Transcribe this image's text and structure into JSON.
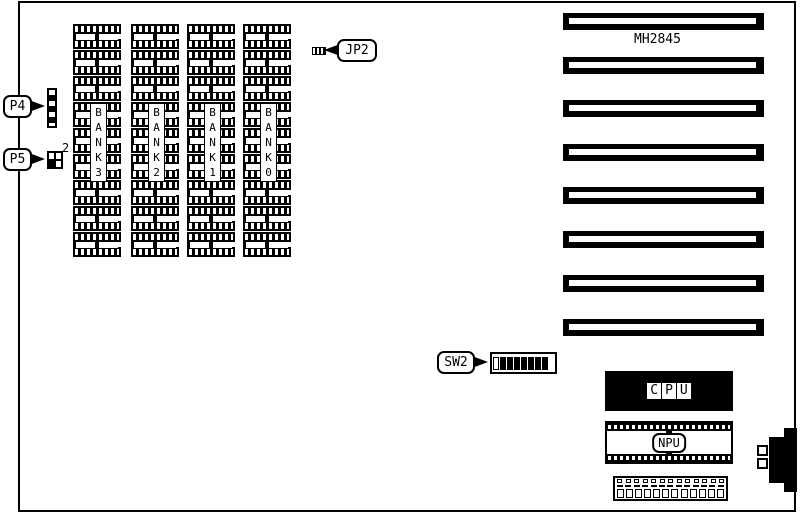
{
  "board": {
    "model": "MH2845",
    "ink_color": "#000000",
    "background_color": "#ffffff"
  },
  "connectors": {
    "p4": {
      "label": "P4"
    },
    "p5": {
      "label": "P5",
      "superscript": "2"
    },
    "jp2": {
      "label": "JP2"
    },
    "keyboard": {
      "name": "din-edge-connector",
      "pin_count": 2
    },
    "bottom_header": {
      "pin_count": 12,
      "clip_count": 13
    }
  },
  "dip_switch": {
    "label": "SW2",
    "positions": [
      "off",
      "on",
      "on",
      "on",
      "on",
      "on",
      "on",
      "on"
    ]
  },
  "memory": {
    "banks": [
      {
        "name": "BANK 3",
        "chars": [
          "B",
          "A",
          "N",
          "K",
          "3"
        ],
        "chip_count": 9
      },
      {
        "name": "BANK 2",
        "chars": [
          "B",
          "A",
          "N",
          "K",
          "2"
        ],
        "chip_count": 9
      },
      {
        "name": "BANK 1",
        "chars": [
          "B",
          "A",
          "N",
          "K",
          "1"
        ],
        "chip_count": 9
      },
      {
        "name": "BANK 0",
        "chars": [
          "B",
          "A",
          "N",
          "K",
          "0"
        ],
        "chip_count": 9
      }
    ]
  },
  "expansion_slots": {
    "count": 8
  },
  "processors": {
    "cpu": {
      "label": "CPU"
    },
    "npu": {
      "label": "NPU"
    }
  }
}
